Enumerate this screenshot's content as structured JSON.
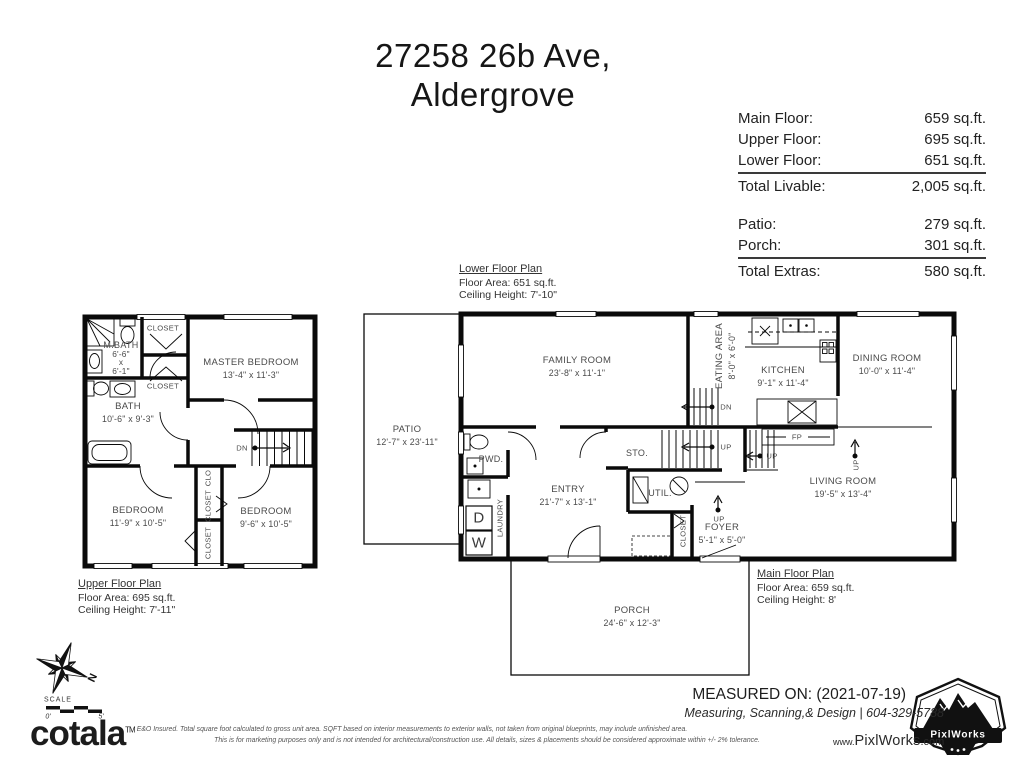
{
  "title": {
    "line1": "27258 26b Ave,",
    "line2": "Aldergrove"
  },
  "area_table": {
    "rows_livable": [
      {
        "label": "Main Floor:",
        "value": "659 sq.ft."
      },
      {
        "label": "Upper Floor:",
        "value": "695 sq.ft."
      },
      {
        "label": "Lower Floor:",
        "value": "651 sq.ft."
      }
    ],
    "total_livable": {
      "label": "Total Livable:",
      "value": "2,005 sq.ft."
    },
    "rows_extras": [
      {
        "label": "Patio:",
        "value": "279 sq.ft."
      },
      {
        "label": "Porch:",
        "value": "301 sq.ft."
      }
    ],
    "total_extras": {
      "label": "Total Extras:",
      "value": "580 sq.ft."
    }
  },
  "captions": {
    "lower": {
      "title": "Lower Floor Plan",
      "area": "Floor Area: 651 sq.ft.",
      "ceiling": "Ceiling Height: 7'-10\""
    },
    "upper": {
      "title": "Upper Floor Plan",
      "area": "Floor Area: 695 sq.ft.",
      "ceiling": "Ceiling Height: 7'-11\""
    },
    "main": {
      "title": "Main Floor Plan",
      "area": "Floor Area: 659 sq.ft.",
      "ceiling": "Ceiling Height: 8'"
    }
  },
  "upper_plan": {
    "mbath": {
      "name": "M.BATH",
      "w": "6'-6\"",
      "sep": "x",
      "h": "6'-1\""
    },
    "closet_top": "CLOSET",
    "closet_mid": "CLOSET",
    "master": {
      "name": "MASTER BEDROOM",
      "dims": "13'-4\" x 11'-3\""
    },
    "bath": {
      "name": "BATH",
      "dims": "10'-6\" x 9'-3\""
    },
    "bedroom1": {
      "name": "BEDROOM",
      "dims": "11'-9\" x 10'-5\""
    },
    "bedroom2": {
      "name": "BEDROOM",
      "dims": "9'-6\" x 10'-5\""
    },
    "clo": "CLO",
    "closet_v1": "CLOSET",
    "closet_v2": "CLOSET",
    "dn": "DN"
  },
  "main_plan": {
    "patio": {
      "name": "PATIO",
      "dims": "12'-7\" x 23'-11\""
    },
    "family": {
      "name": "FAMILY ROOM",
      "dims": "23'-8\" x 11'-1\""
    },
    "eating": {
      "name": "EATING AREA",
      "dims": "8'-0\" x 6'-0\""
    },
    "kitchen": {
      "name": "KITCHEN",
      "dims": "9'-1\" x 11'-4\""
    },
    "dining": {
      "name": "DINING ROOM",
      "dims": "10'-0\" x 11'-4\""
    },
    "living": {
      "name": "LIVING ROOM",
      "dims": "19'-5\" x 13'-4\""
    },
    "entry": {
      "name": "ENTRY",
      "dims": "21'-7\" x 13'-1\""
    },
    "foyer": {
      "name": "FOYER",
      "dims": "5'-1\" x 5'-0\""
    },
    "porch": {
      "name": "PORCH",
      "dims": "24'-6\" x 12'-3\""
    },
    "pwd": "PWD.",
    "laundry": "LAUNDRY",
    "sto": "STO.",
    "util": "UTIL.",
    "closet_v": "CLOSET",
    "fp": "FP",
    "dn": "DN",
    "up": "UP",
    "dryer": "D",
    "washer": "W"
  },
  "compass": {
    "n": "N",
    "scale_label": "SCALE",
    "scale_start": "0'",
    "scale_end": "5'"
  },
  "footer": {
    "measured_on": "MEASURED ON: (2021-07-19)",
    "services": "Measuring, Scanning,& Design | 604-329-5788",
    "website": {
      "prefix": "www.",
      "name": "PixlWorks",
      "suffix": ".com"
    },
    "disclaimer1": "E&O Insured.  Total square foot calculated to gross unit area. SQFT based on interior measurements to exterior walls, not taken from original blueprints, may include unfinished area.",
    "disclaimer2": "This is for marketing purposes only and is not intended for architectural/construction use.  All details, sizes & placements should be considered approximate within +/- 2%  tolerance.",
    "brand": "cotala",
    "brand_tm": "TM",
    "badge": "PixlWorks"
  },
  "colors": {
    "ink": "#111111",
    "label": "#4a4a4a",
    "wall": "#0a0a0a"
  }
}
